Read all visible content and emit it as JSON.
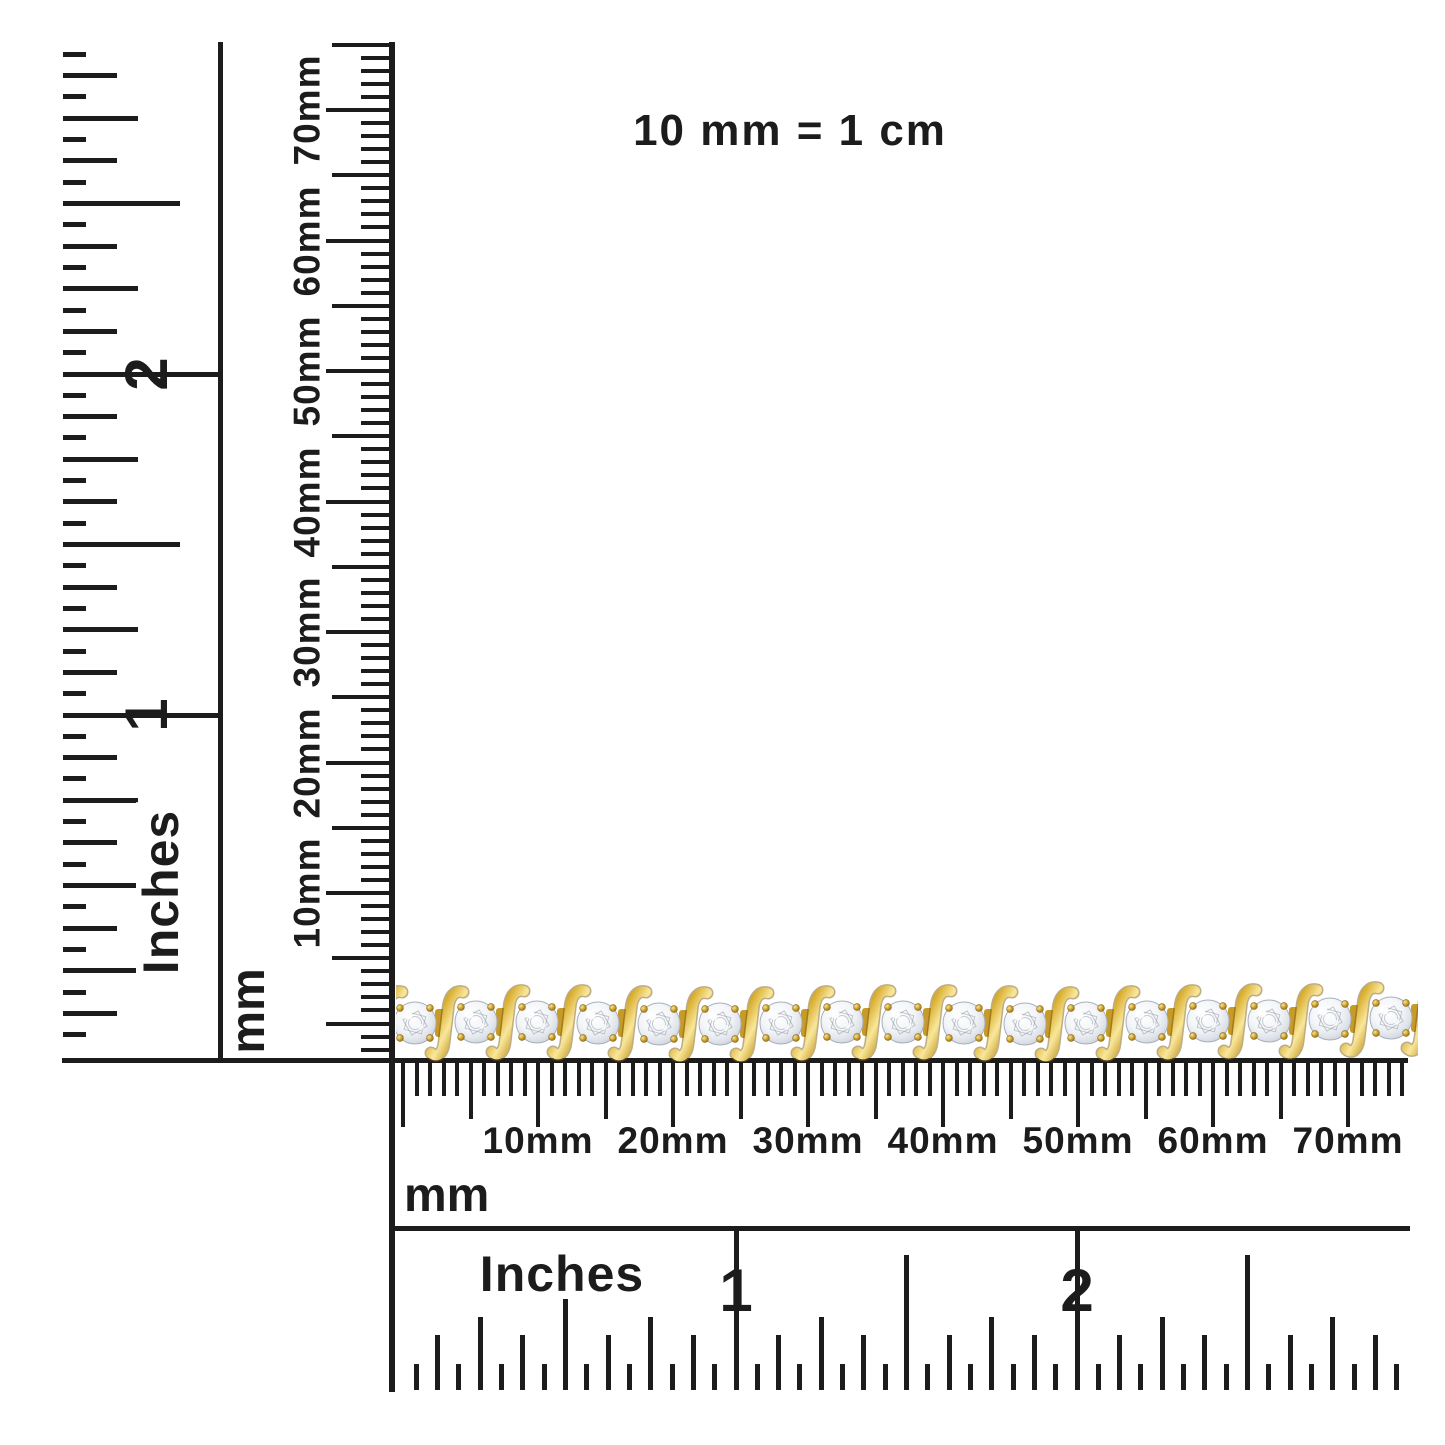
{
  "note": {
    "text": "10 mm = 1 cm"
  },
  "rulers": {
    "left_inches": {
      "unit": "Inches",
      "numbers": [
        "1",
        "2"
      ]
    },
    "left_mm": {
      "unit": "mm",
      "labels": [
        "10mm",
        "20mm",
        "30mm",
        "40mm",
        "50mm",
        "60mm",
        "70mm"
      ]
    },
    "bottom_mm": {
      "unit": "mm",
      "labels": [
        "10mm",
        "20mm",
        "30mm",
        "40mm",
        "50mm",
        "60mm",
        "70mm"
      ]
    },
    "bottom_inches": {
      "unit": "Inches",
      "numbers": [
        "1",
        "2"
      ]
    }
  },
  "bracelet": {
    "description": "yellow gold S-link tennis bracelet with round white diamonds",
    "link_count": 19,
    "colors": {
      "gold_dark": "#8a6410",
      "gold": "#d9ad2e",
      "gold_deep": "#c79b28",
      "gold_light": "#f9e79b",
      "diamond_light": "#ffffff",
      "diamond_mid": "#e0e4ea",
      "diamond_edge": "#bfc5d0",
      "facet_line": "#9aa1ad"
    }
  },
  "colors": {
    "background": "#ffffff",
    "ink": "#1c1c1c"
  }
}
